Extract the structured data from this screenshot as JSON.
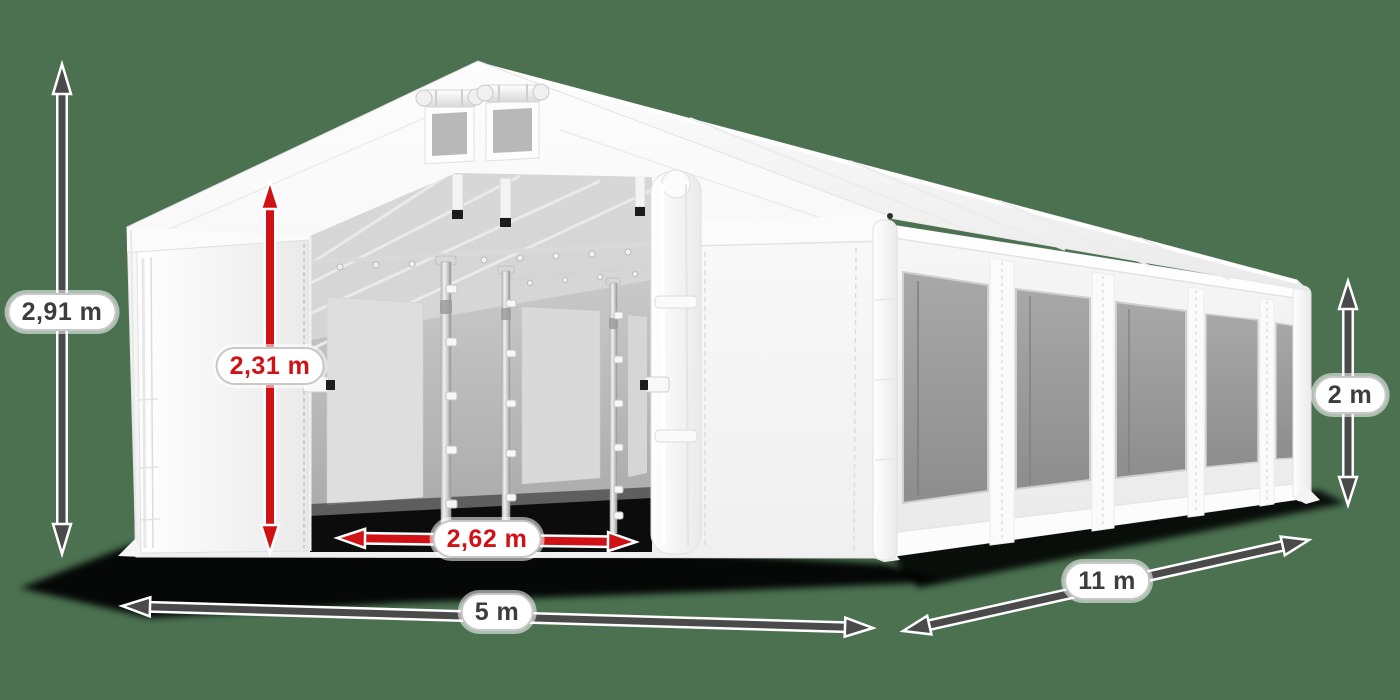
{
  "illustration": {
    "subject": "white-party-tent-3d-view",
    "features": [
      "gable-roof",
      "two-gable-vents",
      "open-front-door",
      "interior-poles",
      "five-side-mesh-windows"
    ]
  },
  "colors": {
    "background": "#4b7151",
    "arrow_dark": "#4a4a4a",
    "arrow_red": "#d01216",
    "pill_background": "#ffffff",
    "pill_border": "#c8c8c8",
    "label_text_dark": "#3d3d3d",
    "tent_white": "#ffffff"
  },
  "dimensions": {
    "total_height": {
      "value": "2,91 m",
      "accent": "dark"
    },
    "door_height": {
      "value": "2,31 m",
      "accent": "red"
    },
    "door_width": {
      "value": "2,62 m",
      "accent": "red"
    },
    "front_width": {
      "value": "5 m",
      "accent": "dark"
    },
    "side_length": {
      "value": "11 m",
      "accent": "dark"
    },
    "side_wall_height": {
      "value": "2 m",
      "accent": "dark"
    }
  }
}
